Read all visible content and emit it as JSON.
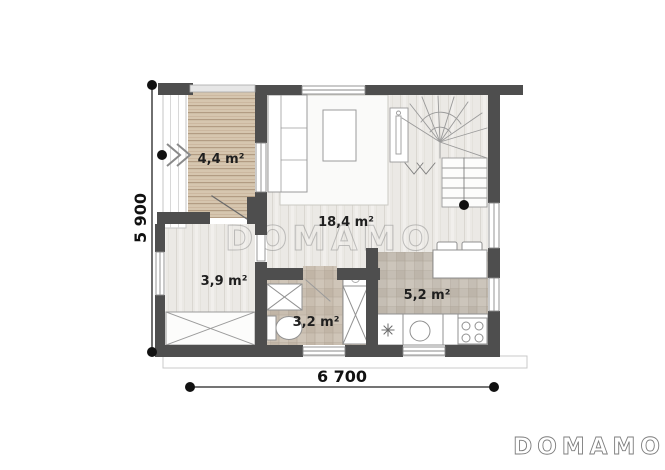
{
  "plan": {
    "watermark_text": "DOMAMO",
    "brand_logo_text": "DOMAMO",
    "rooms": {
      "terrace": "4,4 m²",
      "living": "18,4 m²",
      "hall": "3,9 m²",
      "bathroom": "3,2 m²",
      "kitchen": "5,2 m²"
    },
    "dimensions": {
      "height": "5 900",
      "width": "6 700"
    },
    "colors": {
      "wall": "#4e4e4e",
      "deck_wood": "#d6c6af",
      "floor_plank": "#eceae6",
      "bath_tile": "#c9beb0",
      "kitchen_tile": "#c5beb4",
      "dimension": "#111111"
    }
  }
}
